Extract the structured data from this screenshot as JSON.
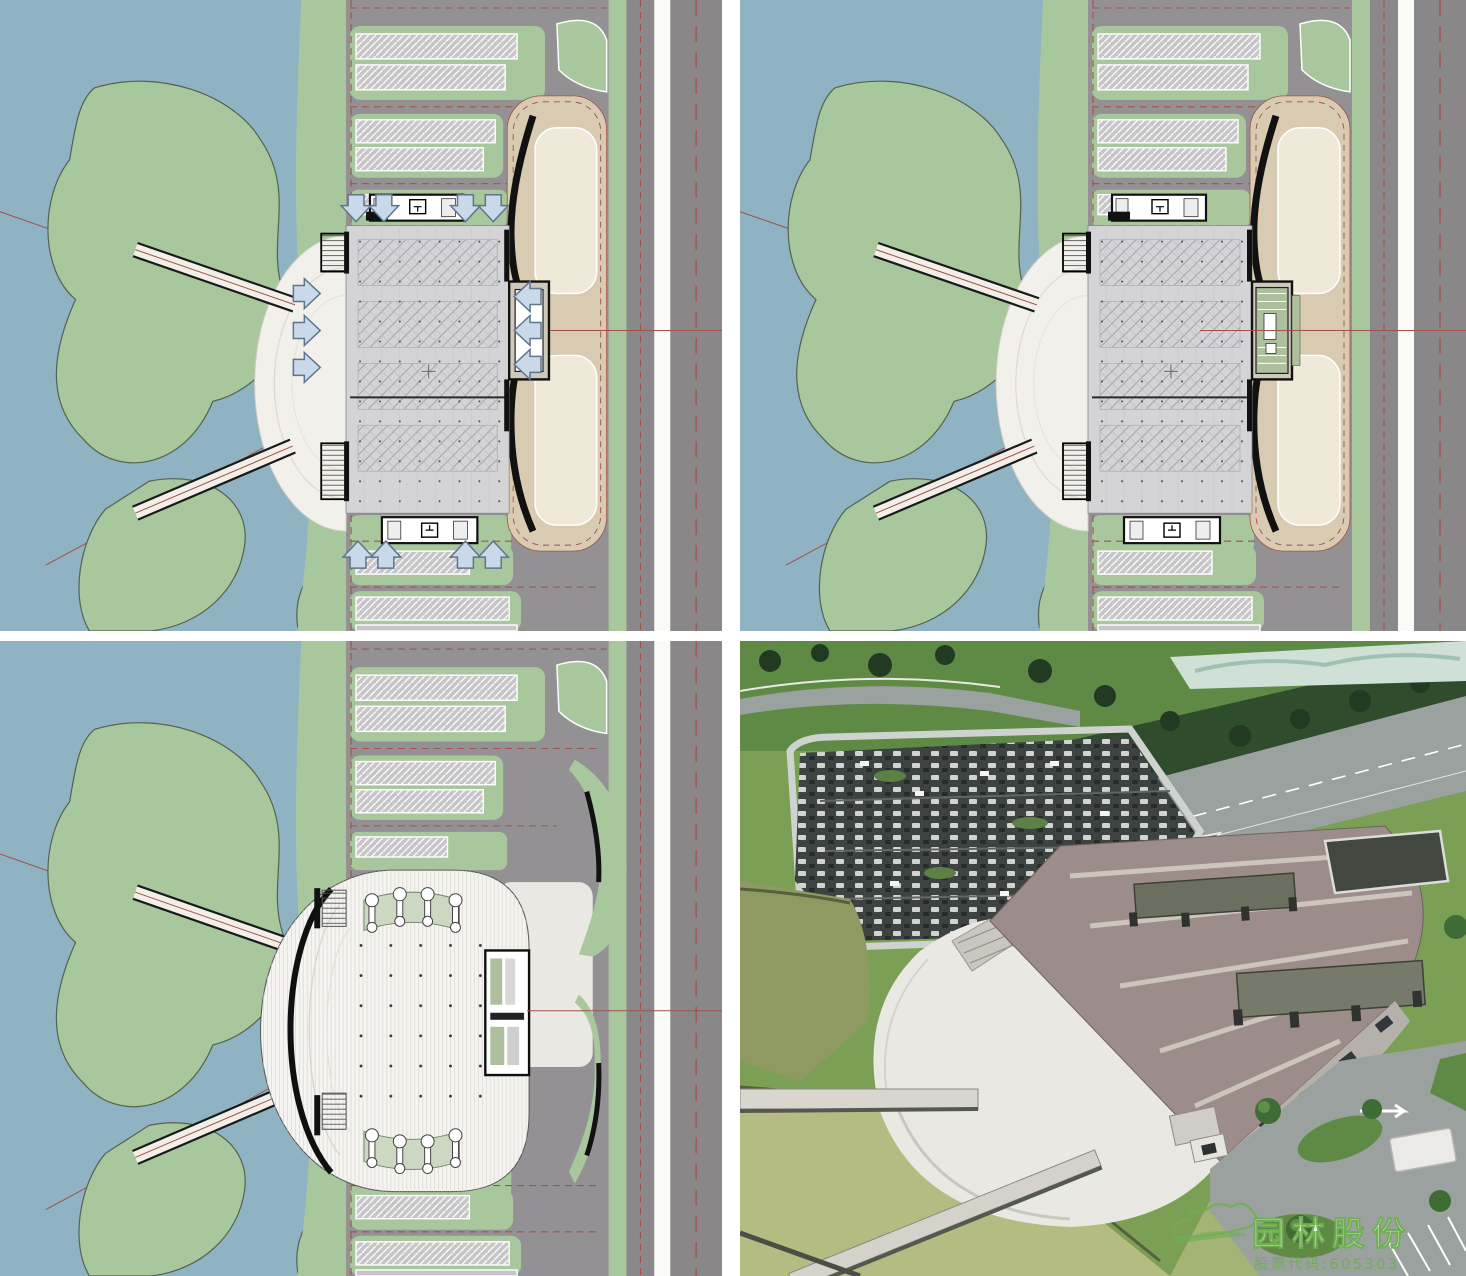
{
  "watermark": {
    "company": "园林股份",
    "stock_code": "股票代码:605303"
  },
  "colors": {
    "water": "#8fb3c3",
    "land": "#a8c79d",
    "land_edge": "#55624f",
    "parking_bg": "#949194",
    "bay_fill": "#c7c5c8",
    "road": "#8b888b",
    "road_wide": "#8a8789",
    "sidewalk": "#fafaf7",
    "red_line": "#a0524a",
    "tan": "#d9cbb2",
    "tan_inner": "#efe9da",
    "bldg_floor": "#d4d4d6",
    "plaza": "#f2f0ea",
    "roof": "#f5f4f0",
    "ink": "#111111",
    "arrow_fill": "#c9d9ea",
    "arrow_edge": "#60748d",
    "photo_grass": "#7ba055",
    "photo_grass_dark": "#5f8a46",
    "photo_trees": "#2f4c2d",
    "photo_asphalt": "#3d4341",
    "photo_road": "#9ba19f",
    "photo_roof": "#9d8d8a",
    "photo_roof_stripe": "#d3cbc4",
    "photo_plaza": "#eae8e2",
    "photo_pond_dark": "#8e9a62",
    "photo_pond": "#b5bc82",
    "photo_teal": "#cfe0d6",
    "wm_green": "#6fae53"
  }
}
